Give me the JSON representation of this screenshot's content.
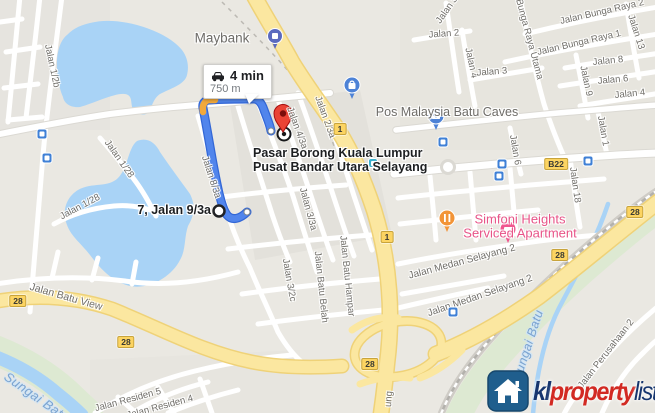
{
  "route_info": {
    "duration": "4 min",
    "distance": "750 m"
  },
  "origin": {
    "label": "7, Jalan 9/3a"
  },
  "destination": {
    "line1": "Pasar Borong Kuala Lumpur",
    "line2": "Pusat Bandar Utara Selayang"
  },
  "poi_labels": [
    {
      "text": "Maybank",
      "x": 222,
      "y": 38,
      "size": 13.5,
      "align": "left"
    },
    {
      "text": "Pos Malaysia Batu Caves",
      "x": 447,
      "y": 112,
      "size": 12.5,
      "align": "left"
    },
    {
      "text": "Simfoni Heights",
      "x": 520,
      "y": 219,
      "size": 13,
      "align": "left",
      "pink": true
    },
    {
      "text": "Serviced Apartment",
      "x": 520,
      "y": 233,
      "size": 13,
      "align": "left",
      "pink": true
    }
  ],
  "road_labels": [
    {
      "text": "Jalan 1/2b",
      "x": 52,
      "y": 66,
      "rot": 78
    },
    {
      "text": "Jalan 1/28",
      "x": 119,
      "y": 159,
      "rot": 55
    },
    {
      "text": "Jalan 1/28",
      "x": 80,
      "y": 207,
      "rot": -28
    },
    {
      "text": "Jalan 8/3a",
      "x": 211,
      "y": 177,
      "rot": 72
    },
    {
      "text": "Jalan 4/3a",
      "x": 297,
      "y": 128,
      "rot": 70
    },
    {
      "text": "Jalan 2/3a",
      "x": 325,
      "y": 117,
      "rot": 70
    },
    {
      "text": "Jalan 3/3a",
      "x": 308,
      "y": 209,
      "rot": 75
    },
    {
      "text": "Jalan 3/2c",
      "x": 289,
      "y": 280,
      "rot": 80
    },
    {
      "text": "Jalan Batu Belah",
      "x": 321,
      "y": 287,
      "rot": 84
    },
    {
      "text": "Jalan Batu Hampar",
      "x": 347,
      "y": 276,
      "rot": 84
    },
    {
      "text": "Jalan Batu View",
      "x": 66,
      "y": 297,
      "rot": 16,
      "size": 10.5
    },
    {
      "text": "Jalan 2",
      "x": 444,
      "y": 34,
      "rot": -4
    },
    {
      "text": "Jalan 3",
      "x": 447,
      "y": 10,
      "rot": -55
    },
    {
      "text": "Jalan 4",
      "x": 471,
      "y": 63,
      "rot": 78
    },
    {
      "text": "Jalan 3",
      "x": 492,
      "y": 72,
      "rot": -4
    },
    {
      "text": "Jalan Bunga Raya Utama",
      "x": 526,
      "y": 27,
      "rot": 75
    },
    {
      "text": "Jalan Bunga Raya 2",
      "x": 602,
      "y": 12,
      "rot": -13
    },
    {
      "text": "Jalan Bunga Raya 1",
      "x": 579,
      "y": 43,
      "rot": -13
    },
    {
      "text": "Jalan 13",
      "x": 636,
      "y": 32,
      "rot": 72
    },
    {
      "text": "Jalan 8",
      "x": 608,
      "y": 61,
      "rot": -6
    },
    {
      "text": "Jalan 6",
      "x": 613,
      "y": 80,
      "rot": -5
    },
    {
      "text": "Jalan 4",
      "x": 630,
      "y": 94,
      "rot": -6
    },
    {
      "text": "Jalan 9",
      "x": 586,
      "y": 81,
      "rot": 78
    },
    {
      "text": "Jalan 6",
      "x": 515,
      "y": 150,
      "rot": 80
    },
    {
      "text": "Jalan 1",
      "x": 603,
      "y": 131,
      "rot": 80
    },
    {
      "text": "Jalan 18",
      "x": 575,
      "y": 185,
      "rot": 82
    },
    {
      "text": "Jalan Medan Selayang 2",
      "x": 462,
      "y": 262,
      "rot": -15,
      "size": 10
    },
    {
      "text": "Jalan Medan Selayang 2",
      "x": 480,
      "y": 296,
      "rot": -19,
      "size": 10
    },
    {
      "text": "Jalan Residen 5",
      "x": 128,
      "y": 400,
      "rot": -15
    },
    {
      "text": "Jalan Residen 4",
      "x": 160,
      "y": 407,
      "rot": -15
    },
    {
      "text": "Jalan Perusahaan 2",
      "x": 606,
      "y": 354,
      "rot": -52
    },
    {
      "text": "ung",
      "x": 389,
      "y": 399,
      "rot": -86
    }
  ],
  "water_labels": [
    {
      "text": "Sungai Batu",
      "x": 37,
      "y": 397,
      "rot": 35,
      "size": 13
    },
    {
      "text": "Sungai Batu",
      "x": 528,
      "y": 345,
      "rot": -72,
      "size": 12.5
    }
  ],
  "shields": [
    {
      "text": "1",
      "x": 340,
      "y": 129
    },
    {
      "text": "1",
      "x": 387,
      "y": 237
    },
    {
      "text": "28",
      "x": 18,
      "y": 301
    },
    {
      "text": "28",
      "x": 126,
      "y": 342
    },
    {
      "text": "28",
      "x": 370,
      "y": 364
    },
    {
      "text": "28",
      "x": 560,
      "y": 255
    },
    {
      "text": "28",
      "x": 635,
      "y": 212
    },
    {
      "text": "B22",
      "x": 556,
      "y": 164
    }
  ],
  "transit_stops": [
    {
      "x": 42,
      "y": 134
    },
    {
      "x": 47,
      "y": 158
    },
    {
      "x": 443,
      "y": 142
    },
    {
      "x": 502,
      "y": 164
    },
    {
      "x": 499,
      "y": 176
    },
    {
      "x": 588,
      "y": 161
    },
    {
      "x": 453,
      "y": 312
    },
    {
      "x": 373,
      "y": 163,
      "variant": "teal"
    }
  ],
  "watermark": {
    "kl": "kl",
    "property": "property",
    "list": "list"
  },
  "icons": {
    "car-icon": "black car glyph in route bubble",
    "bus-stop-icon": "blue square transit stop",
    "train-stop-icon": "teal square transit stop",
    "maybank-pin": "blue balloon map pin",
    "shopping-pin": "blue balloon with shopping bag",
    "post-office-pin": "blue balloon with envelope",
    "restaurant-pin": "orange balloon with fork and knife",
    "lodging-pin": "pink balloon lodging pin",
    "destination-pin": "red teardrop pin",
    "origin-circle": "white circle with black ring",
    "house-icon": "white house on blue tile (watermark)"
  },
  "colors": {
    "land": "#EAE8E2",
    "block": "#E3E1DB",
    "road": "#FFFFFF",
    "road-casing": "#DBD9D3",
    "highway": "#FBE7A0",
    "highway-casing": "#EFD278",
    "water": "#A9D3F6",
    "green": "#DDE9D2",
    "railway": "#B9B6B0",
    "route-blue": "#5185EC",
    "route-casing": "#3367D6",
    "route-orange": "#F2A93C",
    "shield-bg": "#FCD462",
    "shield-border": "#C8A43C",
    "transit-blue": "#3F80D6",
    "transit-teal": "#35AECC",
    "poi-blue": "#4D82D6",
    "maybank-pin": "#5B6ABF",
    "restaurant-orange": "#F29437",
    "lodging-pink": "#F0558E",
    "pin-red": "#EA4335",
    "text-road": "#716F6A",
    "text-poi": "#6E6C68",
    "text-water": "#7BA3CF",
    "text-pink": "#E85488",
    "logo-navy": "#16356E",
    "logo-red": "#D22A23",
    "logo-tile": "#1F5E8D"
  }
}
